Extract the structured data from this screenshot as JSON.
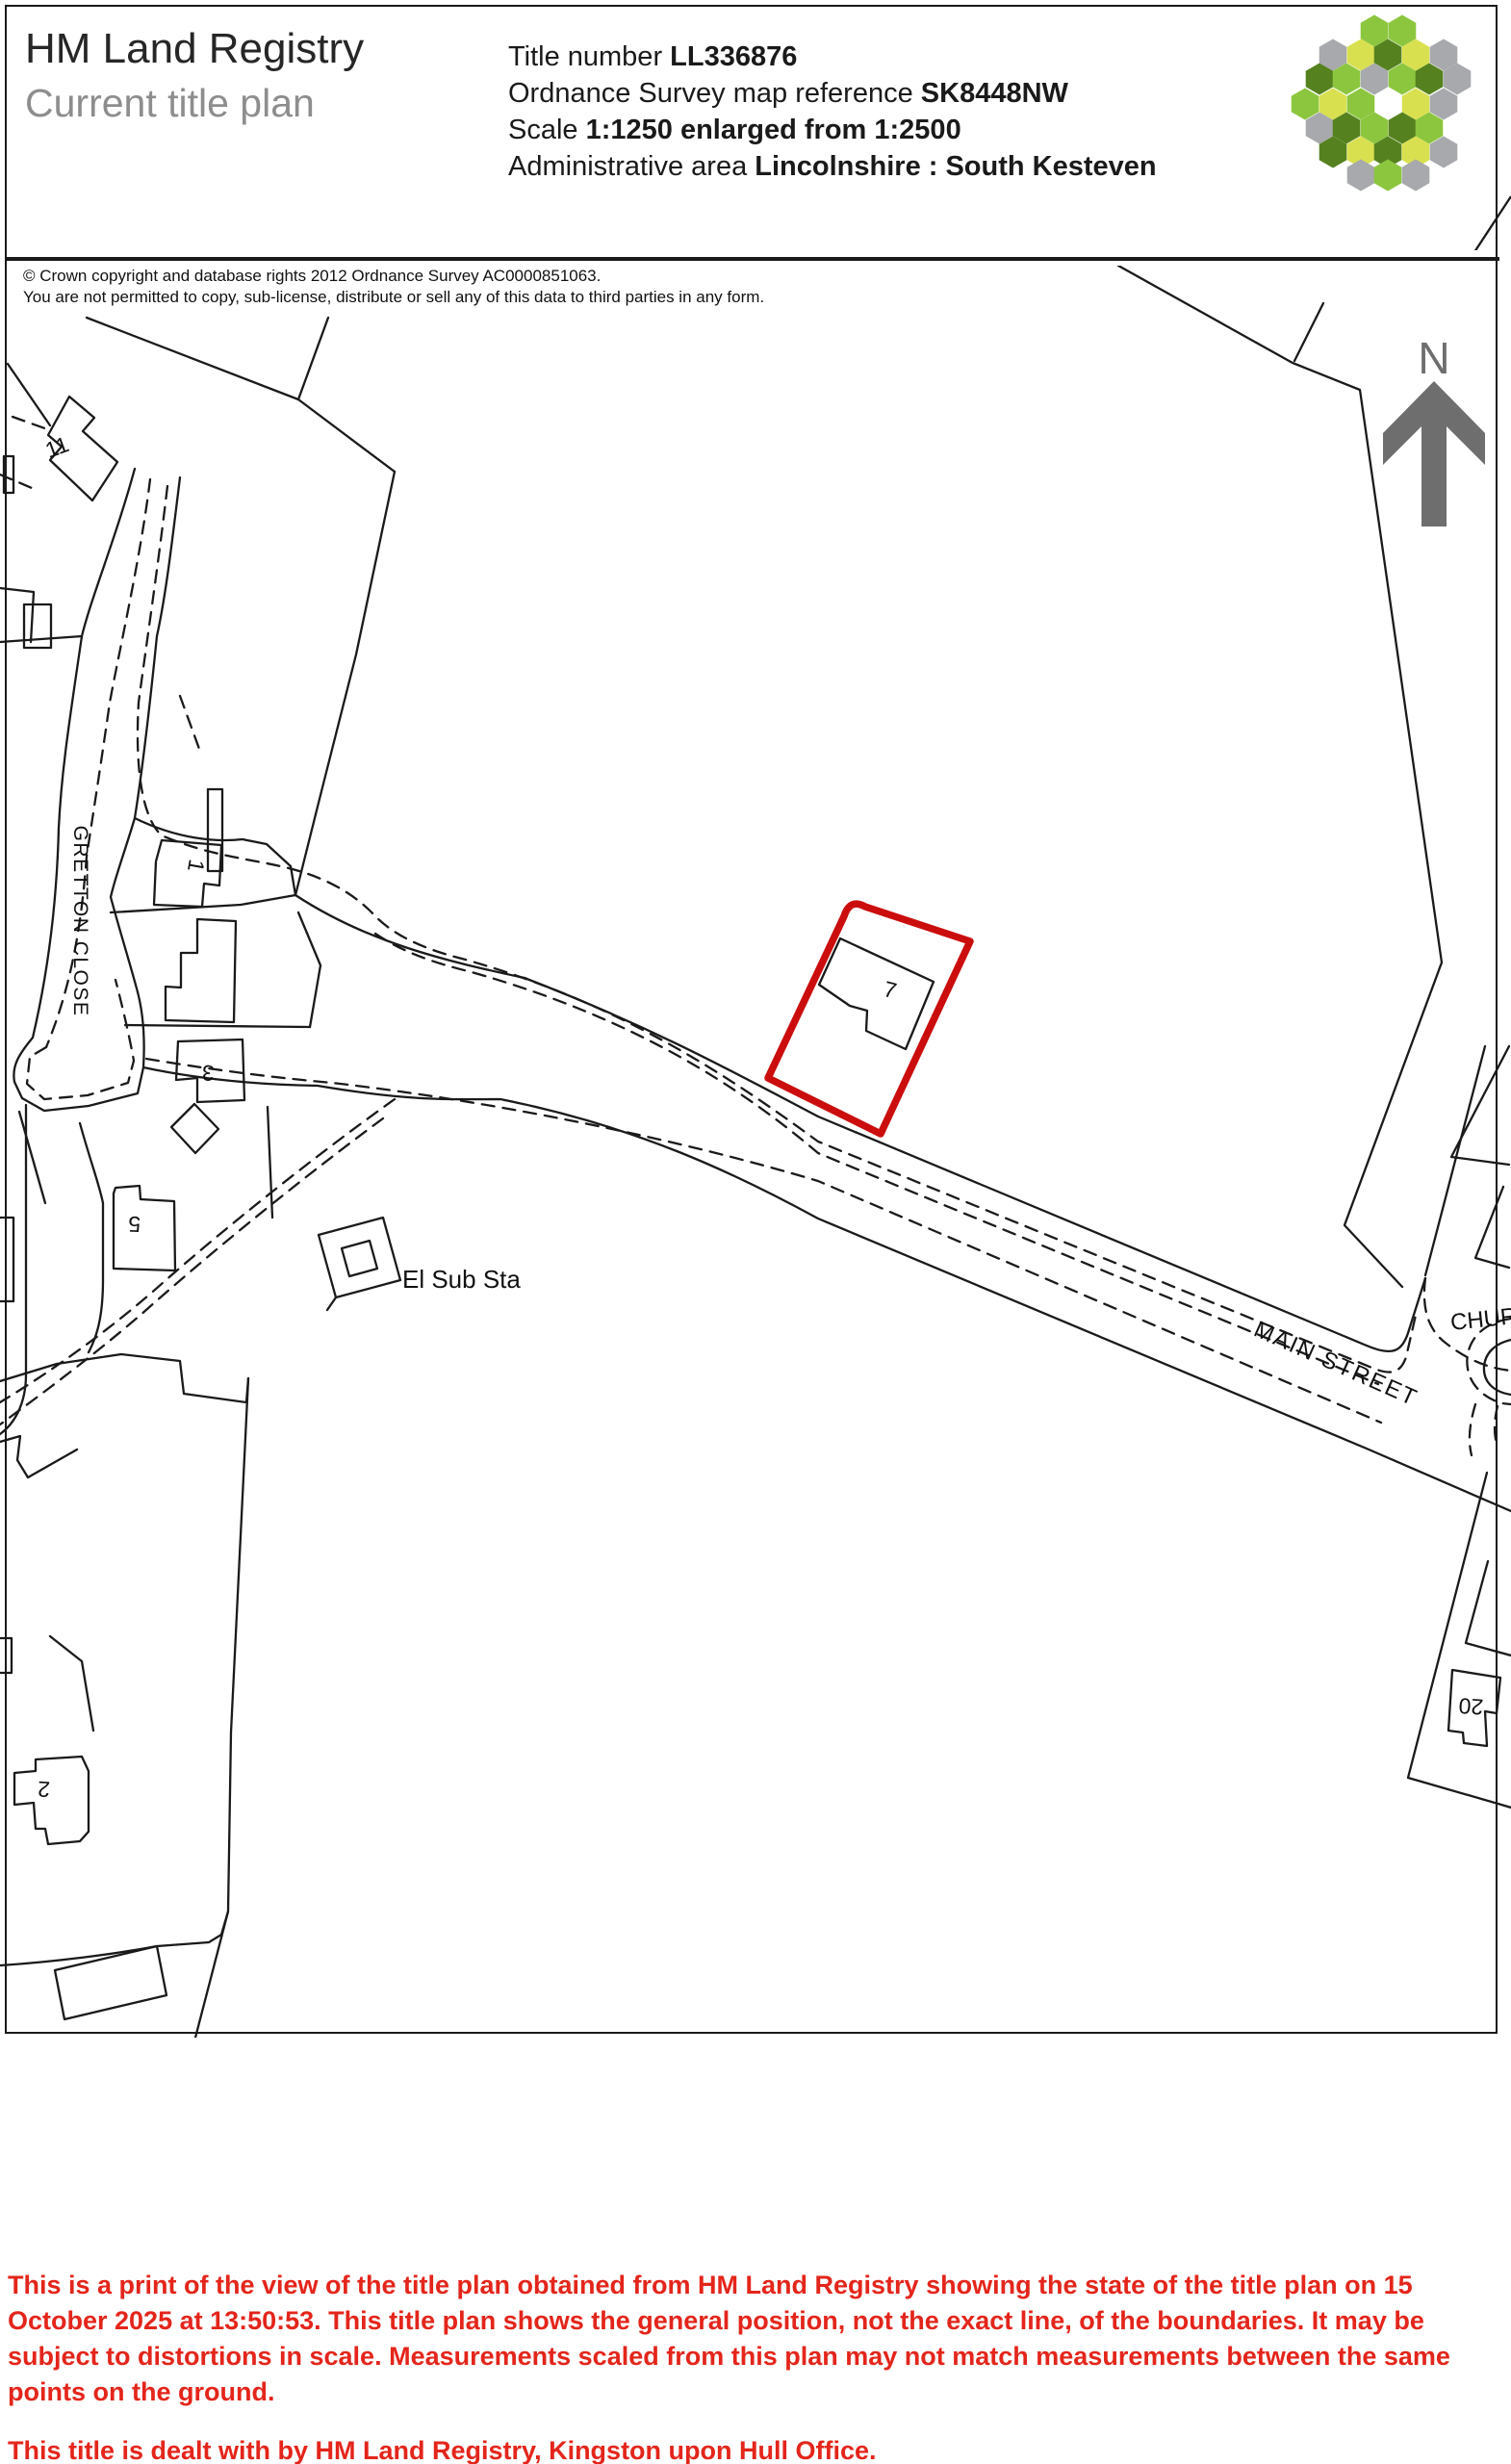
{
  "header": {
    "title": "HM Land Registry",
    "subtitle": "Current title plan",
    "fields": [
      {
        "label": "Title number ",
        "value": "LL336876"
      },
      {
        "label": "Ordnance Survey map reference ",
        "value": "SK8448NW"
      },
      {
        "label": "Scale ",
        "value": "1:1250 enlarged from 1:2500"
      },
      {
        "label": "Administrative area ",
        "value": "Lincolnshire : South Kesteven"
      }
    ]
  },
  "copyright": {
    "line1": "© Crown copyright and database rights 2012 Ordnance Survey AC0000851063.",
    "line2": "You are not permitted to copy, sub-license, distribute or sell any of this data to third parties in any form."
  },
  "compass": {
    "north_label": "N"
  },
  "map": {
    "labels": {
      "gretton_close": "GRETTON CLOSE",
      "el_sub_sta": "El Sub Sta",
      "main_street": "MAIN STREET",
      "church": "CHURCH",
      "plot_1": "1",
      "plot_3": "3",
      "plot_5": "5",
      "plot_7": "7",
      "plot_11": "11",
      "plot_2": "2",
      "plot_20": "20"
    }
  },
  "footer": {
    "paragraph1": "This is a print of the view of the title plan obtained from HM Land Registry showing the state of the title plan on 15 October 2025 at 13:50:53. This title plan shows the general position, not the exact line, of the boundaries. It may be subject to distortions in scale. Measurements scaled from this plan may not match measurements between the same points on the ground.",
    "paragraph2": "This title is dealt with by HM Land Registry, Kingston upon Hull Office."
  },
  "theme": {
    "line": "#1A1A1A",
    "red_parcel": "#CB0D0D",
    "footer_red": "#E4251B",
    "arrow_gray": "#6E6E6E",
    "text_gray": "#8D8D8D",
    "logo_green_light": "#8CC63F",
    "logo_green_dark": "#55821F",
    "logo_yellow": "#D9E04F",
    "logo_gray": "#A7A9AC"
  }
}
